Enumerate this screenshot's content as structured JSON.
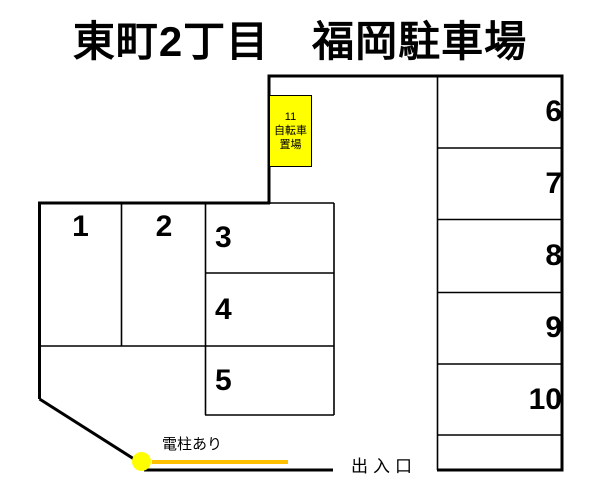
{
  "title": "東町2丁目　福岡駐車場",
  "stalls": [
    {
      "label": "1"
    },
    {
      "label": "2"
    },
    {
      "label": "3"
    },
    {
      "label": "4"
    },
    {
      "label": "5"
    },
    {
      "label": "6"
    },
    {
      "label": "7"
    },
    {
      "label": "8"
    },
    {
      "label": "9"
    },
    {
      "label": "10"
    }
  ],
  "bicycle_area": {
    "number": "11",
    "line1": "自転車",
    "line2": "置場"
  },
  "annotations": {
    "pole": "電柱あり",
    "entrance": "出入口"
  },
  "colors": {
    "highlight_yellow": "#FFFF00",
    "pole_line_orange": "#FFC000",
    "pole_circle_stroke": "#1F3864",
    "outline_black": "#000000"
  }
}
